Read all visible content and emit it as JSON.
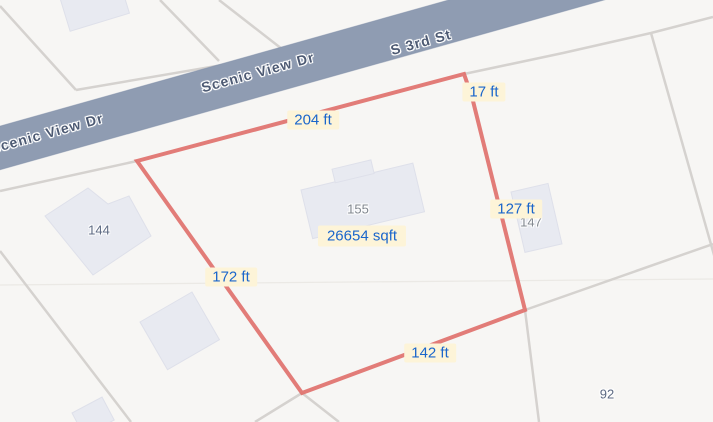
{
  "view": {
    "type": "parcel-map-with-measurements",
    "width": 713,
    "height": 422
  },
  "roads": {
    "upper_label": "Scenic View Dr",
    "lower_label": "Scenic View Dr",
    "cross_street_label": "S 3rd St"
  },
  "measurement": {
    "area": "26654 sqft",
    "edges": [
      "204 ft",
      "17 ft",
      "127 ft",
      "142 ft",
      "172 ft"
    ]
  },
  "house_numbers": {
    "center": "155",
    "west": "144",
    "east": "147",
    "southeast": "92"
  },
  "colors": {
    "map_background": "#f7f6f4",
    "road_fill": "#8f9cb2",
    "road_label_text": "#4d5a73",
    "parcel_line": "#d5d2cf",
    "building_fill": "#e8eaf1",
    "boundary_red": "#e0716c",
    "chip_background": "#fdf4d8",
    "chip_text": "#1b66cb"
  }
}
